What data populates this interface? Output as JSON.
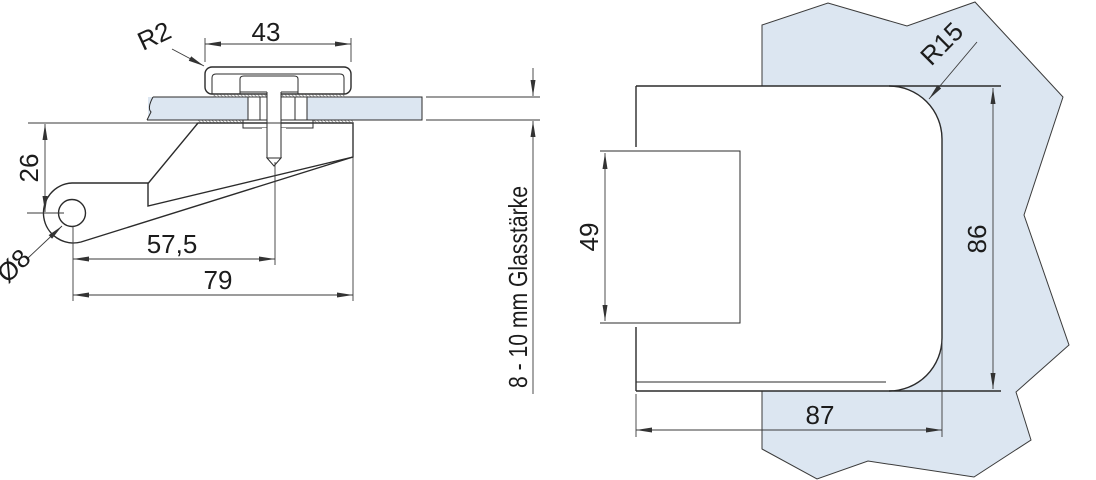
{
  "drawing": {
    "side_view": {
      "dim_cap_width": "43",
      "radius_label": "R2",
      "dim_offset": "26",
      "dia_label": "Ø8",
      "dim_center": "57,5",
      "dim_total": "79",
      "glass_thickness_note": "8 - 10 mm Glasstärke"
    },
    "front_view": {
      "radius_label": "R15",
      "dim_rear_height": "49",
      "dim_height": "86",
      "dim_width": "87"
    },
    "colors": {
      "glass_fill": "#dce6f1",
      "line_color": "#2b2b2b"
    }
  }
}
